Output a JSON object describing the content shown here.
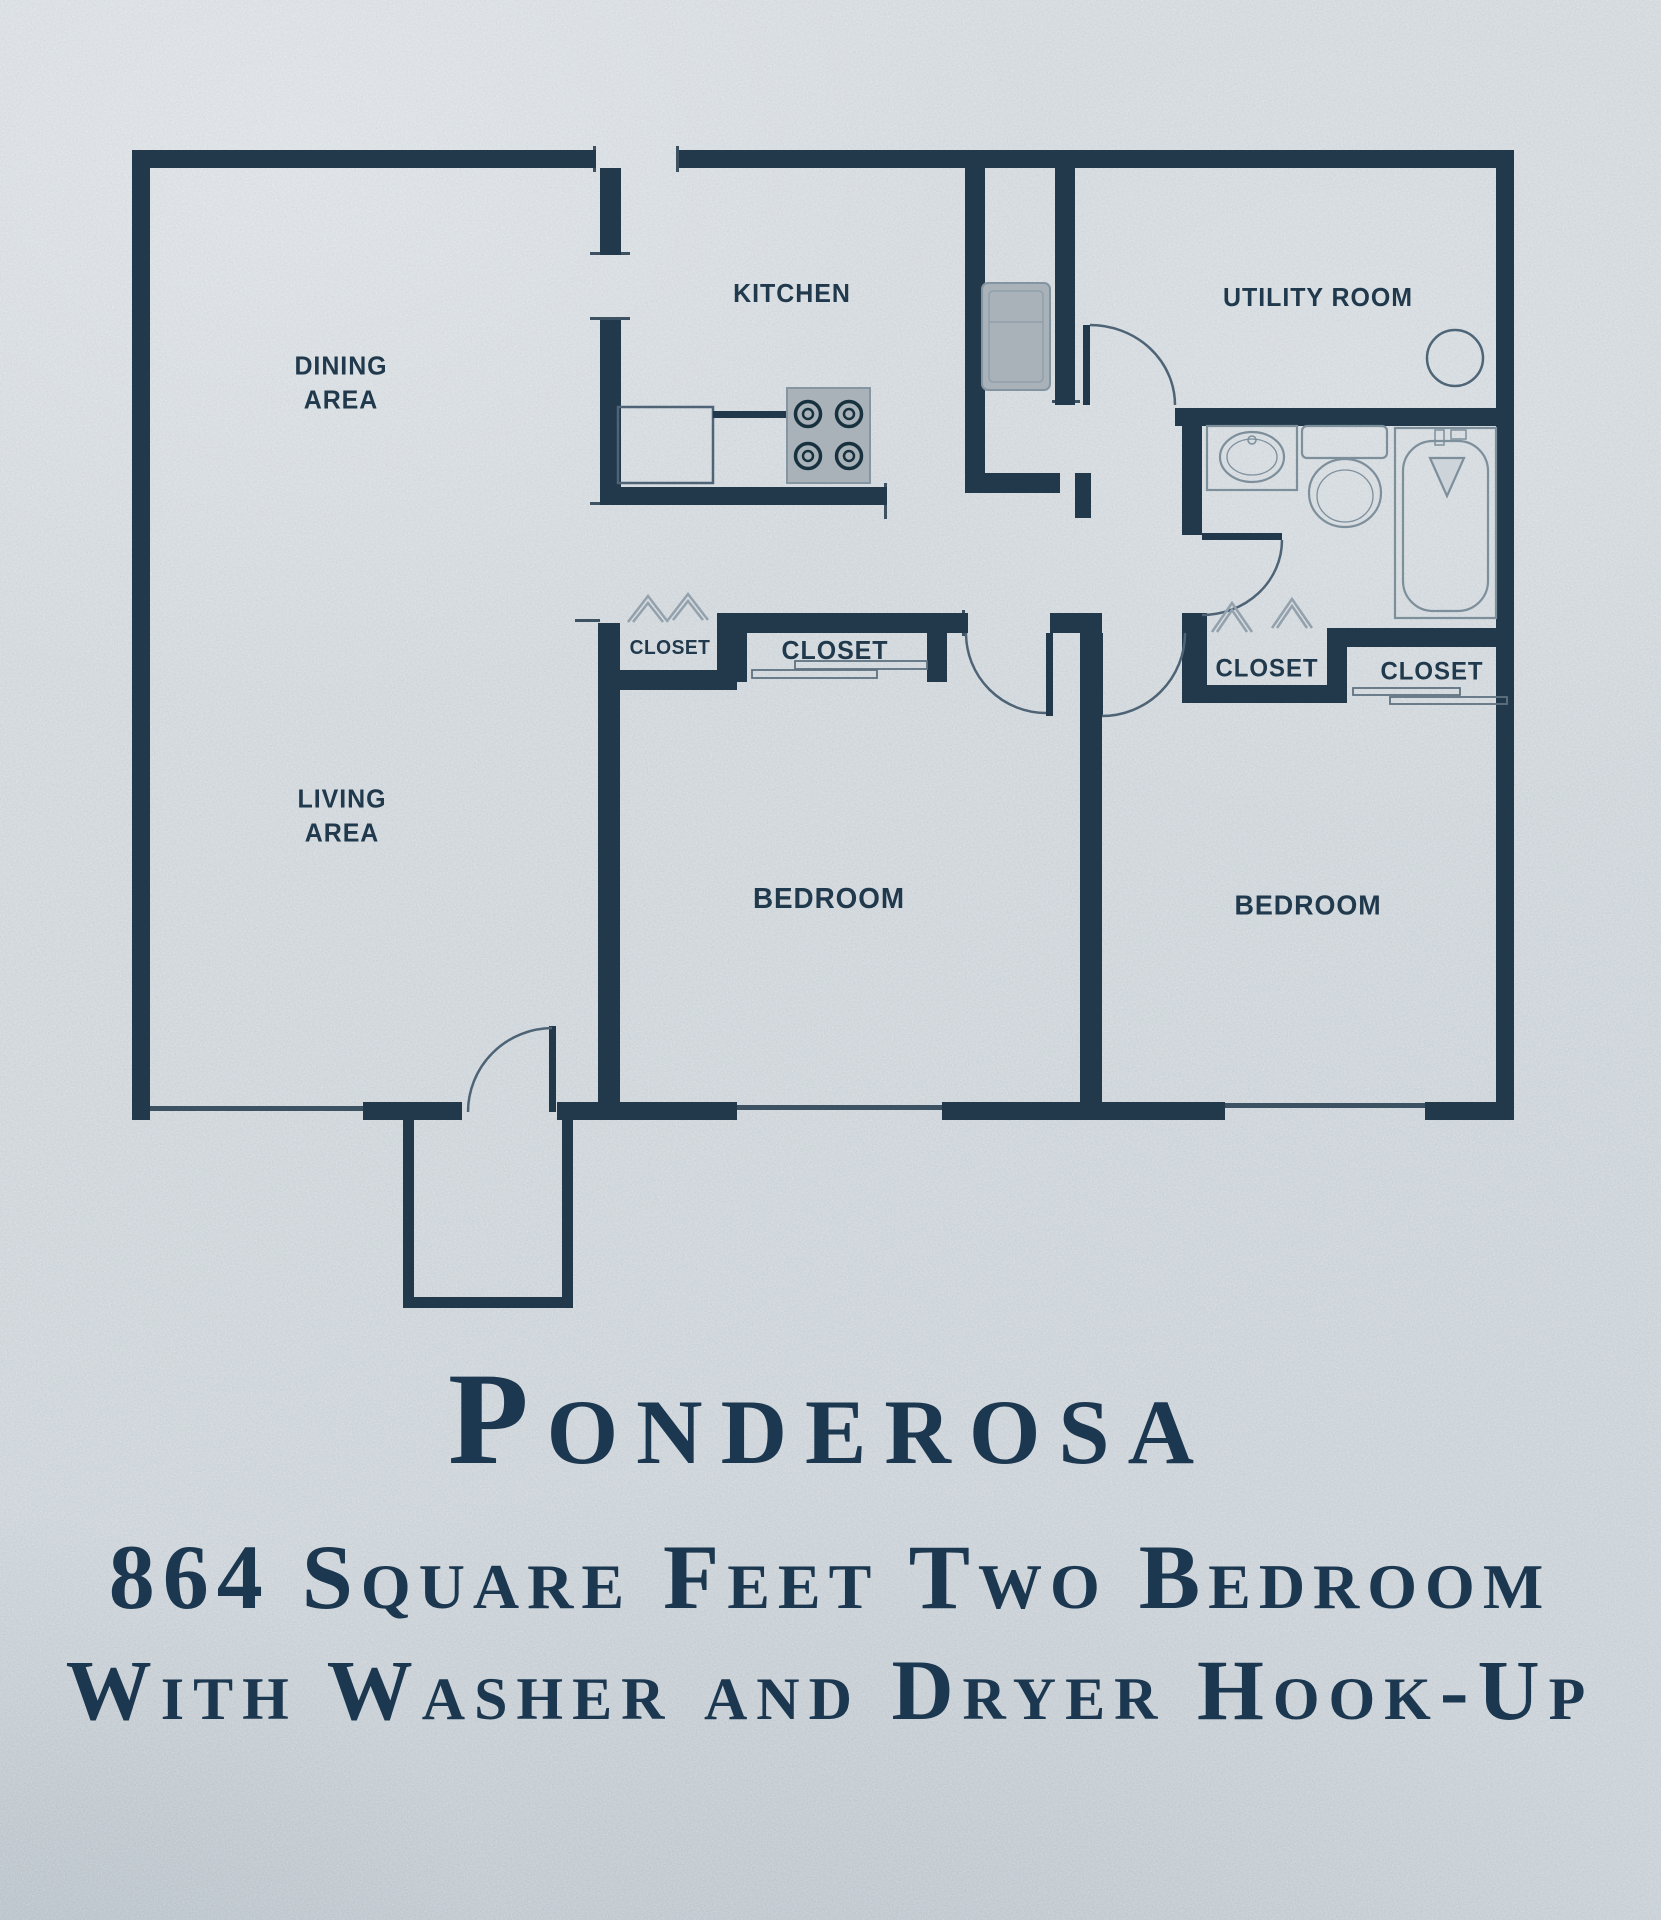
{
  "document": {
    "type": "apartment floor plan sheet",
    "colors": {
      "paper": "#d4dade",
      "ink": "#22394b",
      "thin_line": "#54697b",
      "fixture_line": "#7e8f9c",
      "appliance_fill": "#a9b2b8",
      "title_text": "#1c3750"
    }
  },
  "floor_plan": {
    "rooms": {
      "dining": {
        "label": "DINING\nAREA"
      },
      "kitchen": {
        "label": "KITCHEN"
      },
      "utility": {
        "label": "UTILITY ROOM"
      },
      "living": {
        "label": "LIVING\nAREA"
      },
      "bedroom_left": {
        "label": "BEDROOM"
      },
      "bedroom_right": {
        "label": "BEDROOM"
      },
      "closet_hall": {
        "label": "CLOSET"
      },
      "closet_bedroom_left": {
        "label": "CLOSET"
      },
      "closet_right_a": {
        "label": "CLOSET"
      },
      "closet_right_b": {
        "label": "CLOSET"
      }
    },
    "fixtures": [
      "stove-icon",
      "refrigerator-icon",
      "kitchen-counter",
      "washer-hookup-icon",
      "bathroom-sink-icon",
      "toilet-icon",
      "bathtub-icon",
      "door-swing-arcs",
      "window-lines",
      "bifold-closet-door-symbols",
      "sliding-closet-door-symbols"
    ]
  },
  "title_block": {
    "name": "Ponderosa",
    "line1": "864 Square Feet Two Bedroom",
    "line2": "With Washer and Dryer Hook-Up"
  }
}
